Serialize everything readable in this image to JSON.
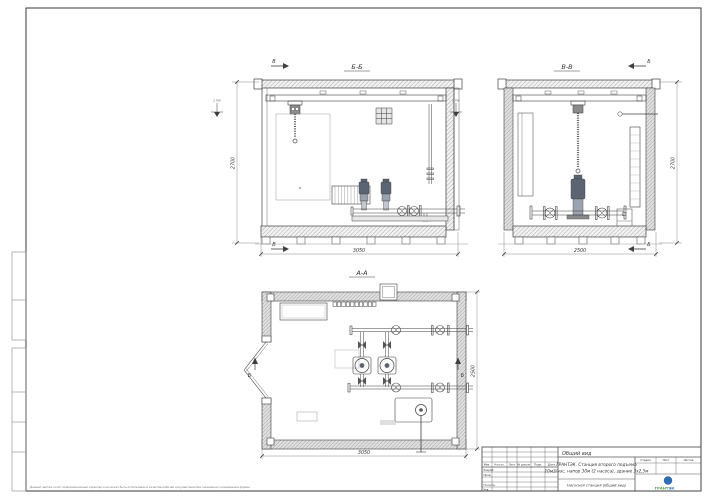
{
  "sheet": {
    "disclaimer": "Данный чертеж носит информационный характер и не может быть использован в качестве рабочей документации без письменного разрешения фирмы",
    "level_mark": "2.700"
  },
  "views": {
    "front": {
      "title": "Б-Б",
      "dim_width": "3050",
      "dim_height": "2700",
      "cut_letter": "В",
      "callout": "а"
    },
    "side": {
      "title": "В-В",
      "dim_width": "2500",
      "dim_height": "2700",
      "cut_letter": "Б"
    },
    "plan": {
      "title": "А-А",
      "dim_width": "3050",
      "dim_height": "2500",
      "cut_letter": "Б"
    }
  },
  "stamp": {
    "doc_type": "Общий вид",
    "title_line1": "ГРАНТЭК. Станция второго подъема",
    "title_line2": "10м3/час, напор 30м (2 насоса), здание 3х2,5м",
    "subtitle": "Насосная станция (общий вид)",
    "columns": [
      "Изм.",
      "Кол.уч.",
      "Лист",
      "№ докум.",
      "Подп.",
      "Дата"
    ],
    "rows": [
      "Разраб.",
      "Пров.",
      "Н.контр.",
      "Утв."
    ],
    "stage_label": "Стадия",
    "sheet_label": "Лист",
    "sheets_label": "Листов",
    "logo_text1": "ГРАНТ",
    "logo_text2": "ЭК"
  },
  "colors": {
    "line": "#3f3f3f",
    "accent_green": "#4f9d4f",
    "accent_blue": "#2d6fb7"
  }
}
